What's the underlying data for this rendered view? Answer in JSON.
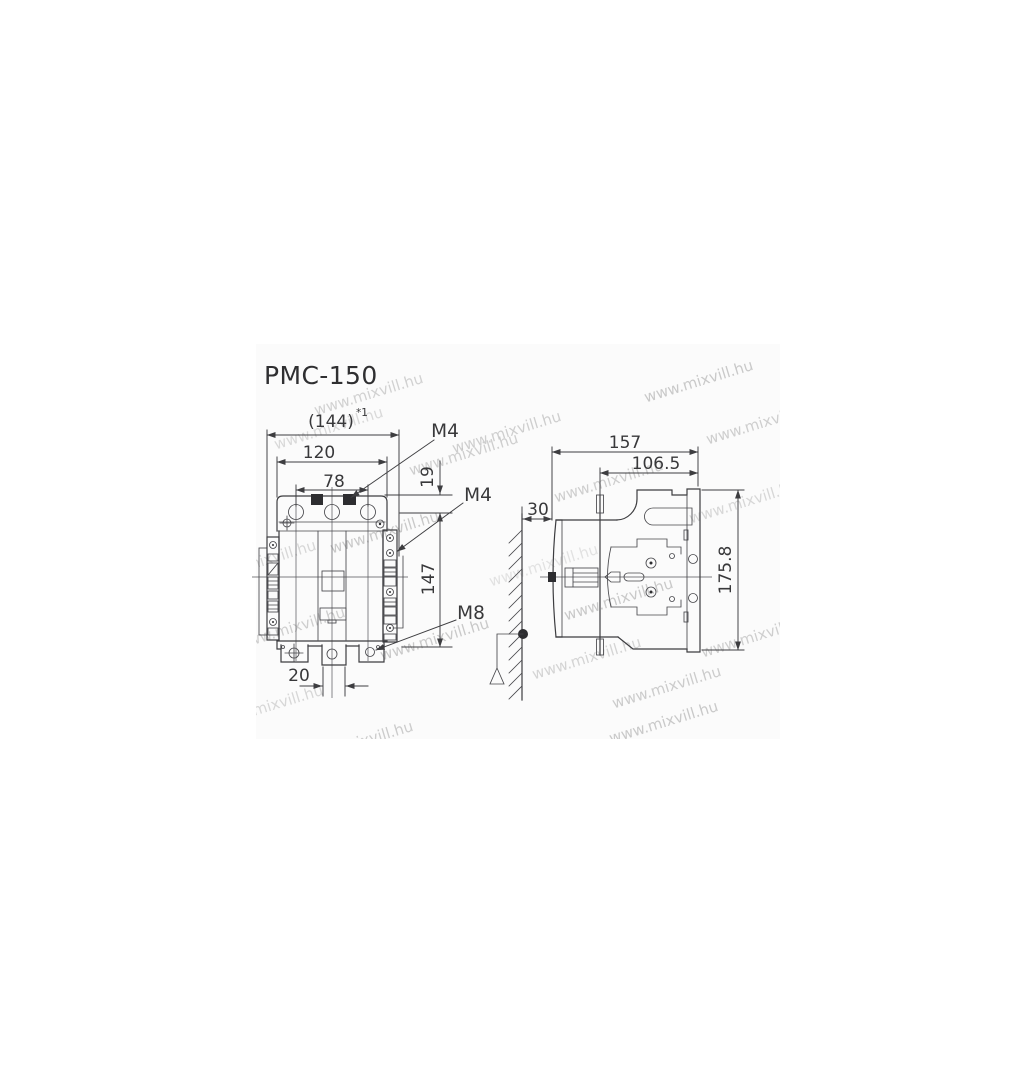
{
  "title": "PMC-150",
  "watermark": {
    "text": "www.mixvill.hu"
  },
  "front_view": {
    "dim_overall_width": "(144)",
    "dim_overall_width_note": "*1",
    "dim_mounting_width": "120",
    "dim_terminal_spacing": "78",
    "dim_top_edge_to_mount": "19",
    "dim_mounting_height": "147",
    "dim_bottom_terminal_width": "20",
    "label_top_terminal_screw": "M4",
    "label_aux_terminal_screw": "M4",
    "label_main_terminal_screw": "M8"
  },
  "side_view": {
    "dim_depth": "157",
    "dim_mount_plane_to_back": "106.5",
    "dim_wall_clearance": "30",
    "dim_height": "175.8"
  },
  "colors": {
    "line": "#3d3d40",
    "text": "#38383a",
    "watermark": "#c4c4c4",
    "band_background": "#fbfbfb",
    "page_background": "#ffffff"
  }
}
